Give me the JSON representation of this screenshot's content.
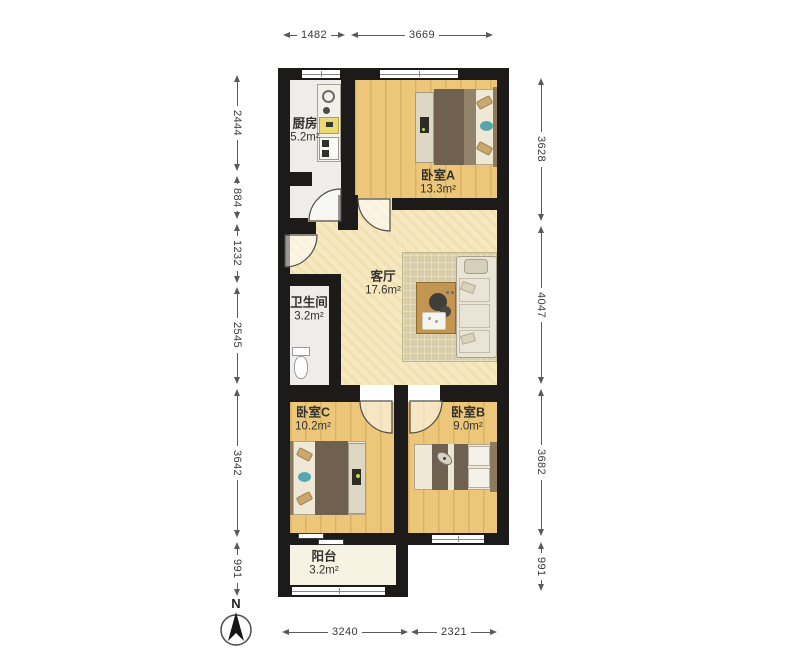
{
  "rooms": {
    "kitchen": {
      "name": "厨房",
      "area": "5.2m²"
    },
    "bedroomA": {
      "name": "卧室A",
      "area": "13.3m²"
    },
    "living": {
      "name": "客厅",
      "area": "17.6m²"
    },
    "bathroom": {
      "name": "卫生间",
      "area": "3.2m²"
    },
    "bedroomC": {
      "name": "卧室C",
      "area": "10.2m²"
    },
    "bedroomB": {
      "name": "卧室B",
      "area": "9.0m²"
    },
    "balcony": {
      "name": "阳台",
      "area": "3.2m²"
    }
  },
  "dimensions_mm": {
    "top": [
      "1482",
      "3669"
    ],
    "left": [
      "2444",
      "884",
      "1232",
      "2545",
      "3642",
      "991"
    ],
    "right": [
      "3628",
      "4047",
      "3682",
      "991"
    ],
    "bottom": [
      "3240",
      "2321"
    ]
  },
  "compass": {
    "label": "N"
  },
  "colors": {
    "wall": "#1d1b1a",
    "bedroom_floor": "#ecc779",
    "living_floor": "#f6e9c2",
    "wet_floor": "#eeede9",
    "balcony_floor": "#f6f3e2",
    "blanket": "#6f6050",
    "accent_teal": "#58a7ad",
    "table": "#c29552",
    "dimension_text": "#3a3a3a"
  }
}
